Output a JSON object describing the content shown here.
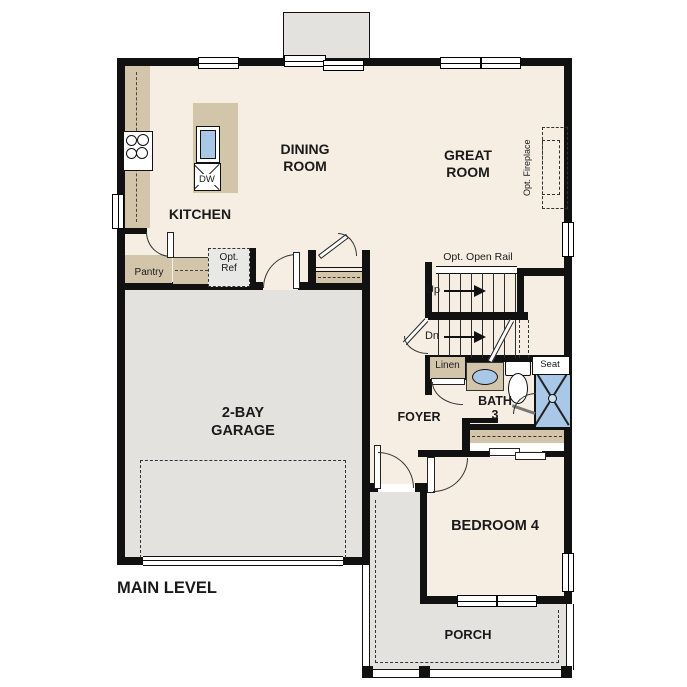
{
  "colors": {
    "floor": "#f7eee3",
    "hard": "#e3e2df",
    "counter": "#d3c5aa",
    "blue": "#a9c8e8",
    "wall": "#111111",
    "text": "#1a1a1a"
  },
  "plan": {
    "level_label": "MAIN LEVEL",
    "rooms": {
      "kitchen": "KITCHEN",
      "dining_1": "DINING",
      "dining_2": "ROOM",
      "great_1": "GREAT",
      "great_2": "ROOM",
      "garage_1": "2-BAY",
      "garage_2": "GARAGE",
      "foyer": "FOYER",
      "bath_1": "BATH",
      "bath_2": "3",
      "bedroom4": "BEDROOM 4",
      "porch": "PORCH"
    },
    "features": {
      "pantry": "Pantry",
      "opt_ref_1": "Opt.",
      "opt_ref_2": "Ref",
      "dw": "DW",
      "linen": "Linen",
      "seat": "Seat",
      "up": "Up",
      "dn": "Dn",
      "open_rail": "Opt. Open Rail",
      "fireplace": "Opt. Fireplace"
    }
  }
}
